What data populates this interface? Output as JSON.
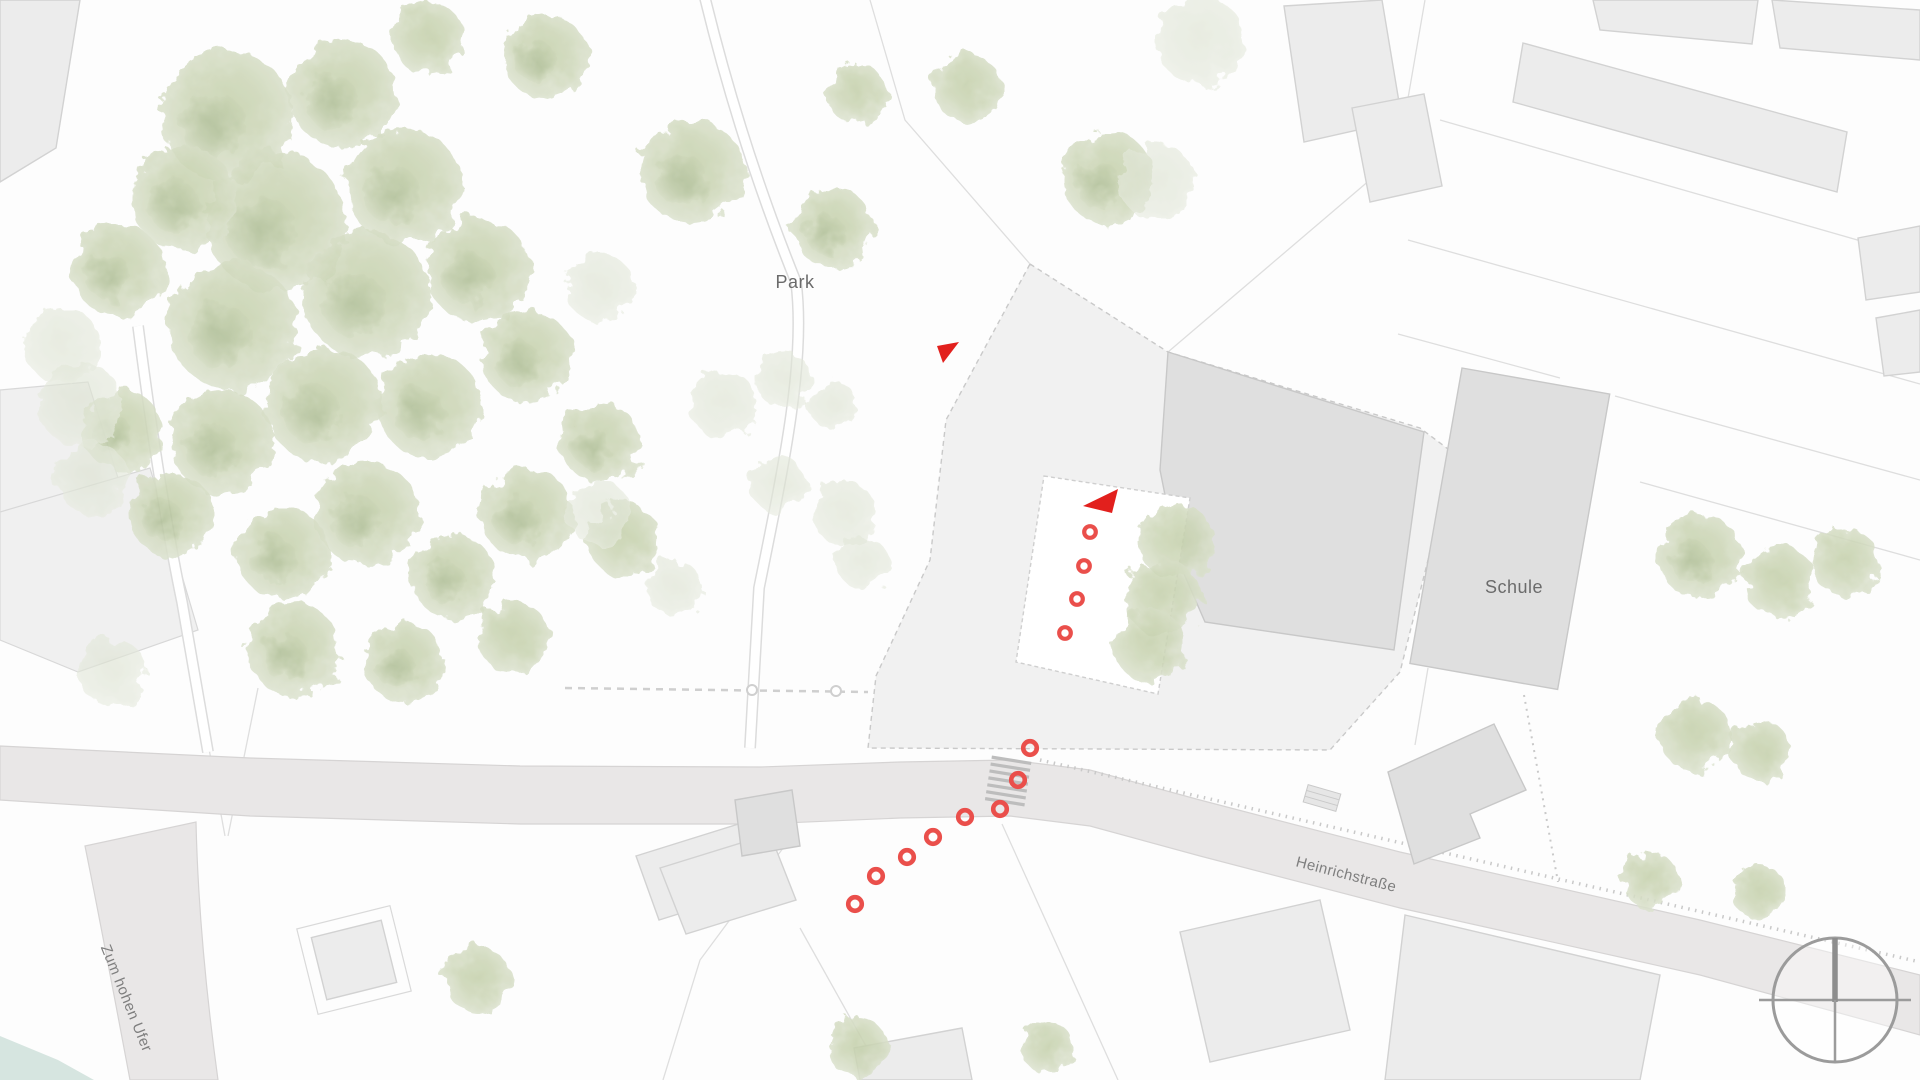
{
  "map": {
    "labels": {
      "park": "Park",
      "school": "Schule",
      "street_main": "Heinrichstraße",
      "street_side": "Zum hohen Ufer"
    },
    "colors": {
      "background": "#fdfdfd",
      "street": "#e9e7e7",
      "building_light": "#ececec",
      "building_dark": "#dfdfdf",
      "parcel": "#f1f1f1",
      "tree_green": "#ccd6b6",
      "water_teal": "#cfe0da",
      "marker_ring": "#ea4f4b",
      "marker_triangle": "#e2201d",
      "label_text": "#6b6b6b"
    },
    "annotations": {
      "triangles": [
        {
          "points": "937,346 959,342 943,363"
        },
        {
          "points": "1083,506 1118,489 1112,513"
        }
      ],
      "courtyard_rings": [
        [
          1090,
          532
        ],
        [
          1084,
          566
        ],
        [
          1077,
          599
        ],
        [
          1065,
          633
        ]
      ],
      "path_rings": [
        [
          1030,
          748
        ],
        [
          1018,
          780
        ],
        [
          1000,
          809
        ],
        [
          965,
          817
        ],
        [
          933,
          837
        ],
        [
          907,
          857
        ],
        [
          876,
          876
        ],
        [
          855,
          904
        ]
      ],
      "crosswalk": {
        "x": 1008,
        "y": 782,
        "stripes": 7
      },
      "compass": {
        "x": 1835,
        "y": 1000,
        "r": 62
      }
    },
    "vegetation": {
      "trees_main": [
        [
          227,
          116,
          66
        ],
        [
          343,
          94,
          54
        ],
        [
          276,
          222,
          70
        ],
        [
          404,
          186,
          58
        ],
        [
          184,
          198,
          52
        ],
        [
          118,
          270,
          46
        ],
        [
          233,
          326,
          64
        ],
        [
          367,
          295,
          64
        ],
        [
          478,
          270,
          52
        ],
        [
          324,
          405,
          58
        ],
        [
          222,
          442,
          52
        ],
        [
          429,
          405,
          52
        ],
        [
          527,
          356,
          46
        ],
        [
          367,
          514,
          52
        ],
        [
          282,
          552,
          46
        ],
        [
          527,
          514,
          46
        ],
        [
          453,
          576,
          42
        ],
        [
          600,
          442,
          40
        ],
        [
          624,
          540,
          36
        ],
        [
          171,
          514,
          42
        ],
        [
          122,
          430,
          40
        ],
        [
          294,
          650,
          46
        ],
        [
          404,
          662,
          40
        ],
        [
          514,
          638,
          36
        ],
        [
          545,
          56,
          42
        ],
        [
          428,
          38,
          36
        ],
        [
          692,
          172,
          52
        ],
        [
          833,
          228,
          40
        ],
        [
          1108,
          178,
          46
        ],
        [
          967,
          88,
          34
        ],
        [
          857,
          94,
          30
        ],
        [
          1177,
          542,
          38
        ],
        [
          1162,
          597,
          38
        ],
        [
          1150,
          646,
          36
        ],
        [
          1700,
          556,
          42
        ],
        [
          1780,
          582,
          36
        ],
        [
          1845,
          562,
          34
        ],
        [
          1695,
          735,
          36
        ],
        [
          1762,
          752,
          30
        ],
        [
          1650,
          880,
          28
        ],
        [
          1760,
          893,
          27
        ],
        [
          478,
          980,
          33
        ],
        [
          857,
          1047,
          30
        ],
        [
          1047,
          1047,
          26
        ]
      ],
      "trees_pale": [
        [
          600,
          288,
          34
        ],
        [
          723,
          404,
          34
        ],
        [
          784,
          380,
          28
        ],
        [
          833,
          405,
          24
        ],
        [
          778,
          484,
          28
        ],
        [
          845,
          514,
          32
        ],
        [
          863,
          563,
          26
        ],
        [
          600,
          514,
          32
        ],
        [
          674,
          588,
          28
        ],
        [
          80,
          404,
          42
        ],
        [
          92,
          478,
          36
        ],
        [
          112,
          672,
          34
        ],
        [
          62,
          345,
          38
        ],
        [
          1200,
          40,
          44
        ],
        [
          1157,
          182,
          38
        ]
      ]
    }
  }
}
